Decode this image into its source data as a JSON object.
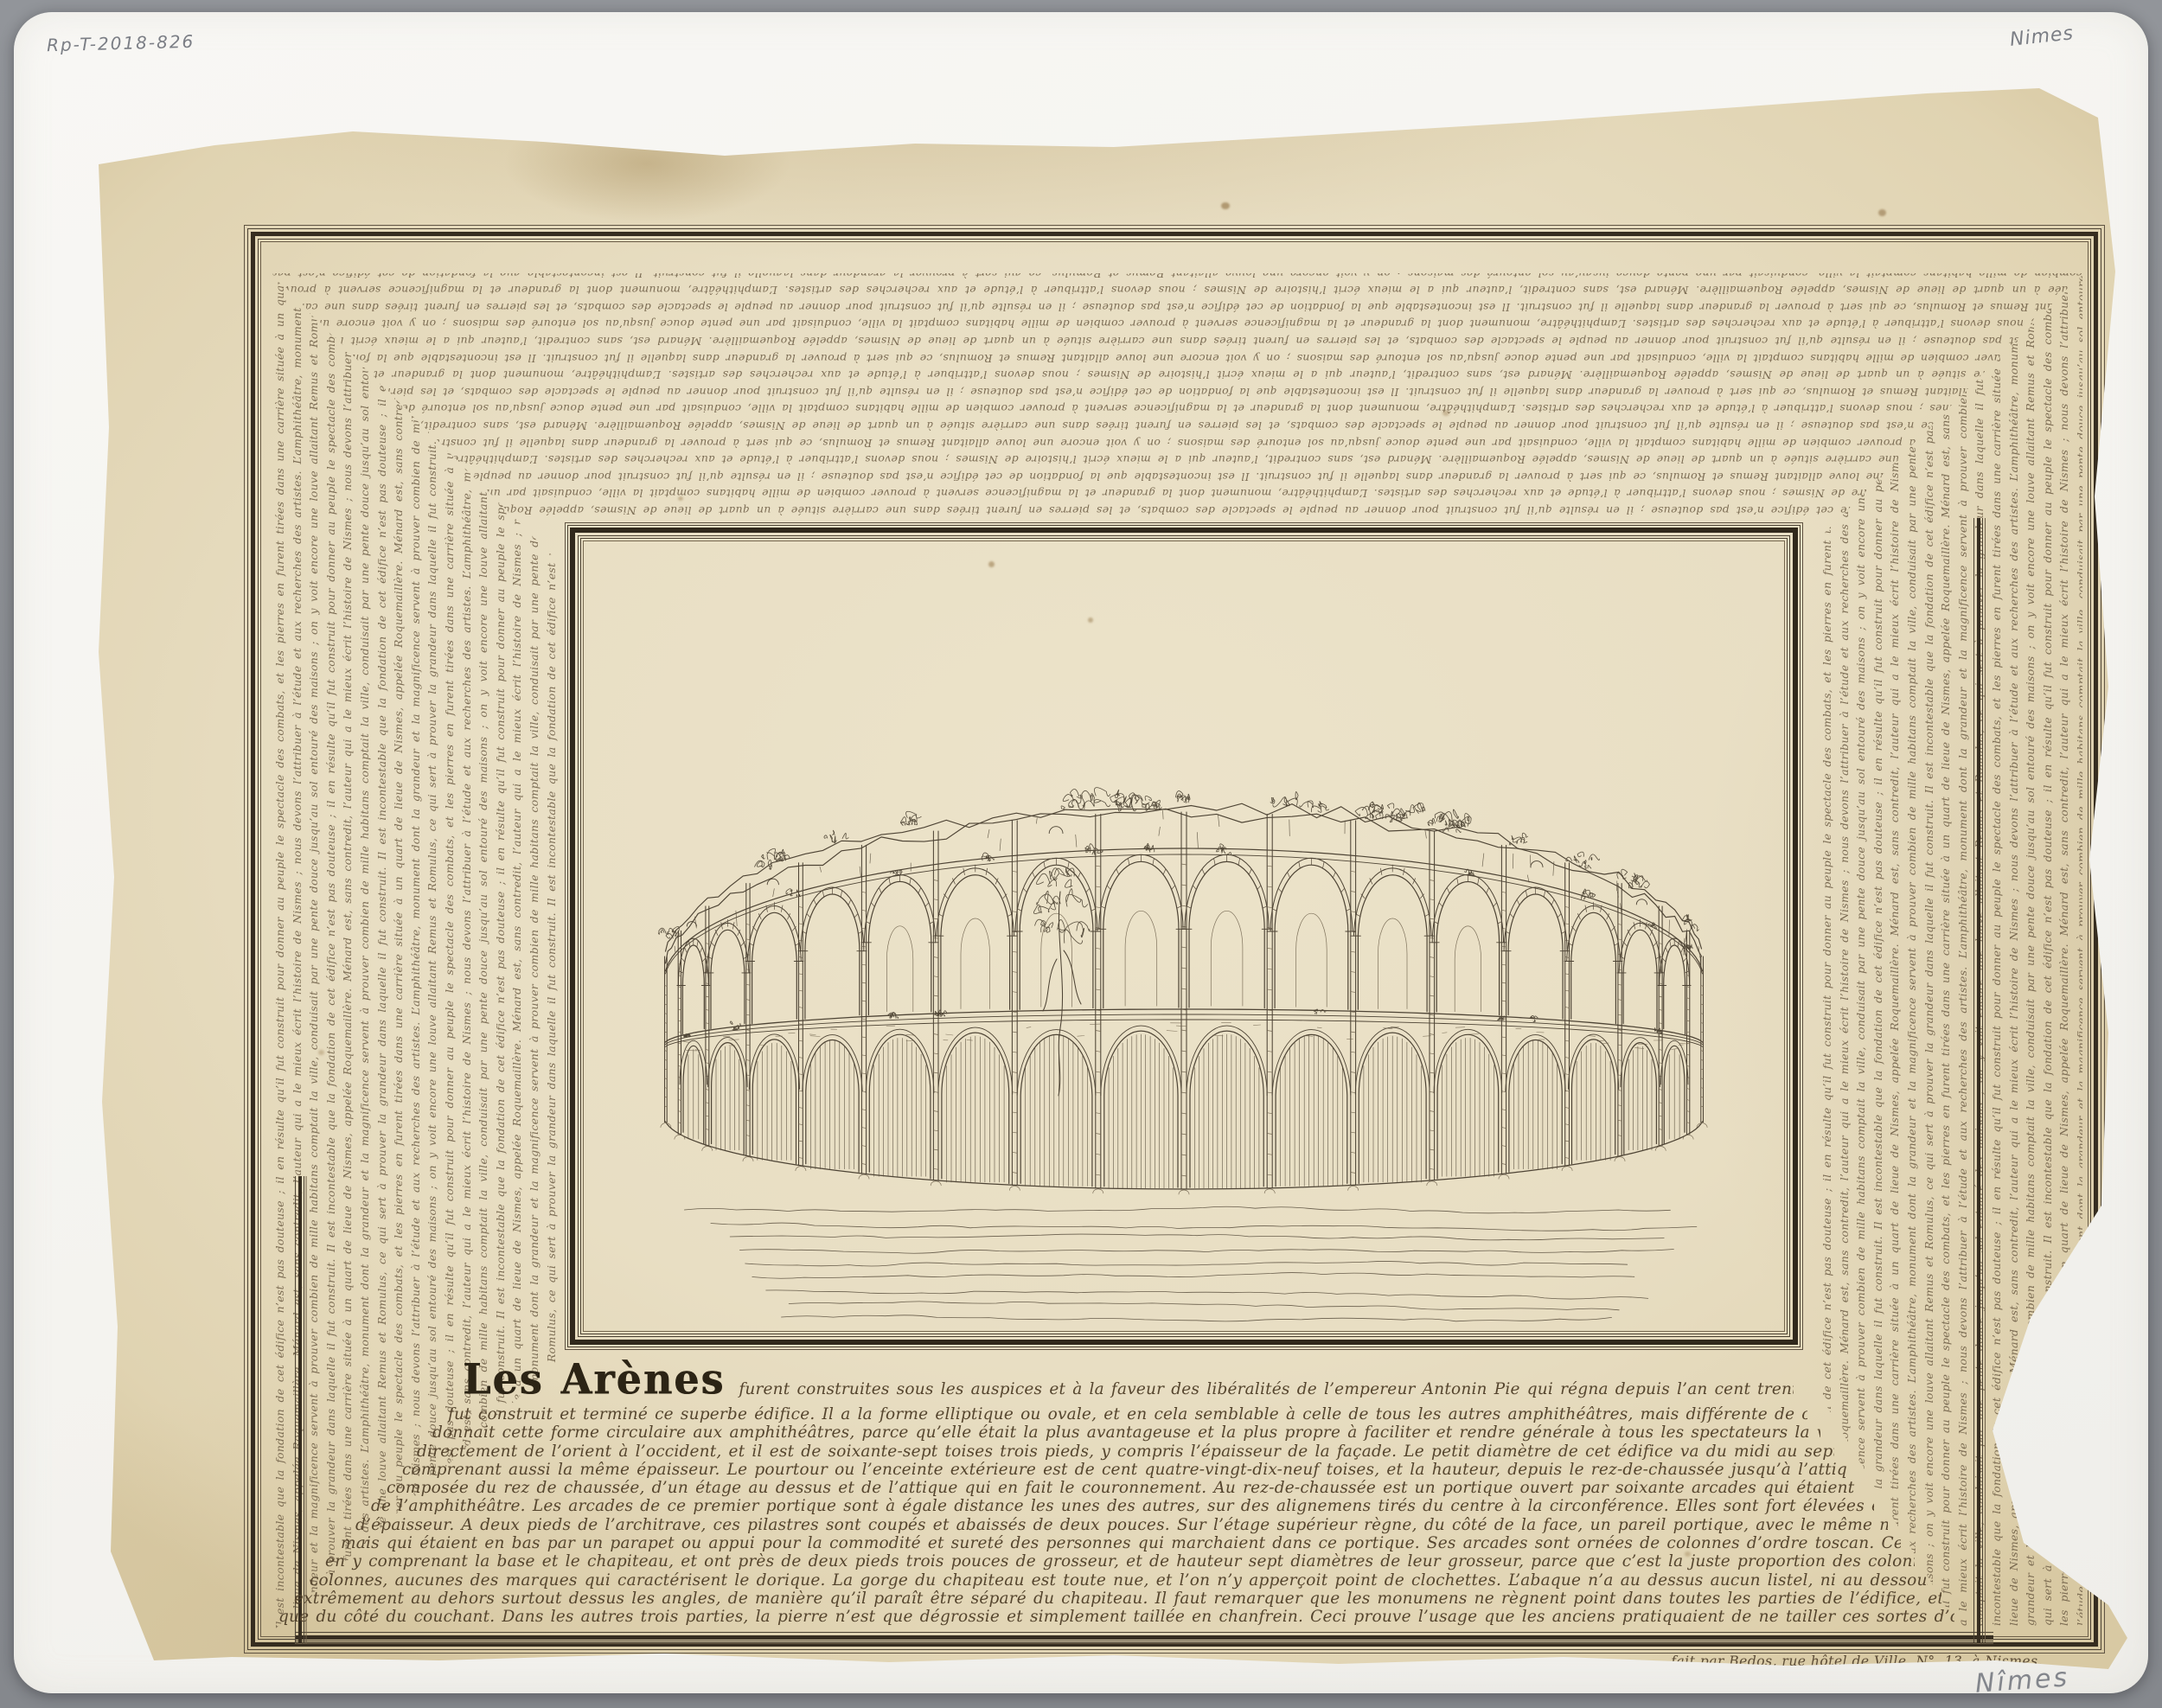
{
  "annotations": {
    "inventory_number": "Rp-T-2018-826",
    "top_right_pencil": "Nimes",
    "bottom_right_pencil": "Nîmes",
    "price_note": "Prix : 10 francs"
  },
  "artwork": {
    "title": "Les Arènes",
    "caption_lines": [
      "furent construites sous les auspices et à la faveur des libéralités de l’empereur Antonin Pie qui régna depuis l’an cent trente-huit de Jésus-Christ jusqu’en l’année cent soixante-un, que",
      "fut construit et terminé ce superbe édifice. Il a la forme elliptique ou ovale, et en cela semblable à celle de tous les autres amphithéâtres, mais différente de celle de quelques uns, en ce que c’est un ovale parfait. On don",
      "donnait cette forme circulaire aux amphithéâtres, parce qu’elle était la plus avantageuse et la plus propre à faciliter et rendre générale à tous les spectateurs la vue des exercices. Le grand diamètre de cet édifice tend",
      "directement de l’orient à l’occident, et il est de soixante-sept toises trois pieds, y compris l’épaisseur de la façade. Le petit diamètre de cet édifice va du midi au septentrion, et il a cinquante-deux toises cinq pieds, en y",
      "comprenant aussi la même épaisseur. Le pourtour ou l’enceinte extérieure est de cent quatre-vingt-dix-neuf toises, et la hauteur, depuis le rez-de-chaussée jusqu’à l’attique, est de dix toises cinq pieds onze pouces. La façade est",
      "composée du rez de chaussée, d’un étage au dessus et de l’attique qui en fait le couronnement. Au rez-de-chaussée est un portique ouvert par soixante arcades qui étaient autant de portes par lesquelles on entrait dans l’intérieur",
      "de l’amphithéâtre. Les arcades de ce premier portique sont à égale distance les unes des autres, sur des alignemens tirés du centre à la circonférence. Elles sont fort élevées et ornées d’un pilastre qui a près de deux pieds de front et autant",
      "d’épaisseur. A deux pieds de l’architrave, ces pilastres sont coupés et abaissés de deux pouces. Sur l’étage supérieur règne, du côté de la face, un pareil portique, avec le même nombre d’arcades perpendiculaires à celles du dessous ;",
      "mais qui étaient en bas par un parapet ou appui pour la commodité et sureté des personnes qui marchaient dans ce portique. Ses arcades sont ornées de colonnes d’ordre toscan. Ces colonnes croissent de dix-huit pieds de hauteur",
      "en y comprenant la base et le chapiteau, et ont près de deux pieds trois pouces de grosseur, et de hauteur sept diamètres de leur grosseur, parce que c’est la juste proportion des colonnes d’ordre toscan. Outre cela, on ne voit dans ces colon",
      "colonnes, aucunes des marques qui caractérisent le dorique. La gorge du chapiteau est toute nue, et l’on n’y apperçoit point de clochettes. L’abaque n’a au dessus aucun listel, ni au dessous aucun ove. Il sort",
      "extrêmement au dehors surtout dessus les angles, de manière qu’il paraît être séparé du chapiteau. Il faut remarquer que les monumens ne règnent point dans toutes les parties de l’édifice, et que les moulures de son architecture ne sont taillées",
      "que du côté du couchant. Dans les autres trois parties, la pierre n’est que dégrossie et simplement taillée en chanfrein. Ceci prouve l’usage que les anciens pratiquaient de ne tailler ces sortes d’ornemens que lorsque les pierres étaient en place, et cela, afin"
    ],
    "signature": "fait par Bedos, rue hôtel de Ville, N°. 13, à Nismes.",
    "border_text": "Il est incontestable que la fondation de cet édifice n’est pas douteuse ; il en résulte qu’il fut construit pour donner au peuple le spectacle des combats, et les pierres en furent tirées dans une carrière située à un quart de lieue de Nismes, appelée Roquemaillère. Ménard est, sans contredit, l’auteur qui a le mieux écrit l’histoire de Nismes ; nous devons l’attribuer à l’étude et aux recherches des artistes. L’amphithéâtre, monument dont la grandeur et la magnificence servent à prouver combien de mille habitans comptait la ville, conduisait par une pente douce jusqu’au sol entouré des maisons ; on y voit encore une louve allaitant Remus et Romulus, ce qui sert à prouver la grandeur dans laquelle il fut construit. "
  },
  "colors": {
    "background": "#8b8e93",
    "mat": "#f6f5f1",
    "paper": "#e8dec3",
    "frame_ink": "#362d20",
    "script_ink": "#6e5e46",
    "caption_ink": "#55452e",
    "pencil": "#7b7e85"
  }
}
